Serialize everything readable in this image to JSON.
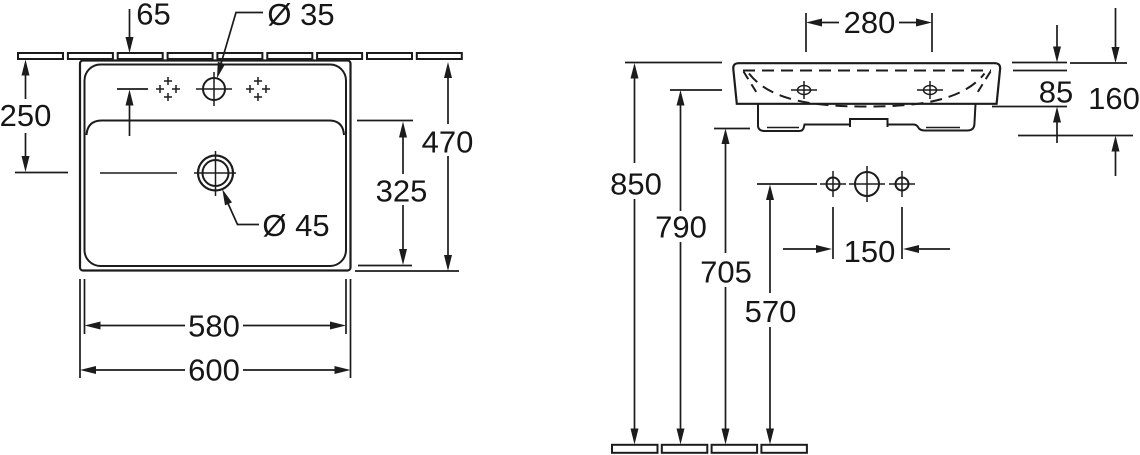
{
  "colors": {
    "ink": "#1c1c1c",
    "background": "#ffffff"
  },
  "top_view": {
    "dims": {
      "faucet_offset_from_wall": "65",
      "faucet_hole_diameter": "Ø 35",
      "drain_offset_from_wall": "250",
      "overall_depth": "470",
      "bowl_depth": "325",
      "drain_diameter": "Ø 45",
      "bowl_width": "580",
      "overall_width": "600"
    }
  },
  "front_view": {
    "dims": {
      "side_hole_spacing": "280",
      "rim_to_bowl_bottom": "85",
      "rim_to_apron_bottom": "160",
      "rim_height": "850",
      "hole_line_height": "790",
      "apron_bottom_height": "705",
      "outlet_height": "570",
      "fixing_hole_spacing": "150"
    }
  }
}
